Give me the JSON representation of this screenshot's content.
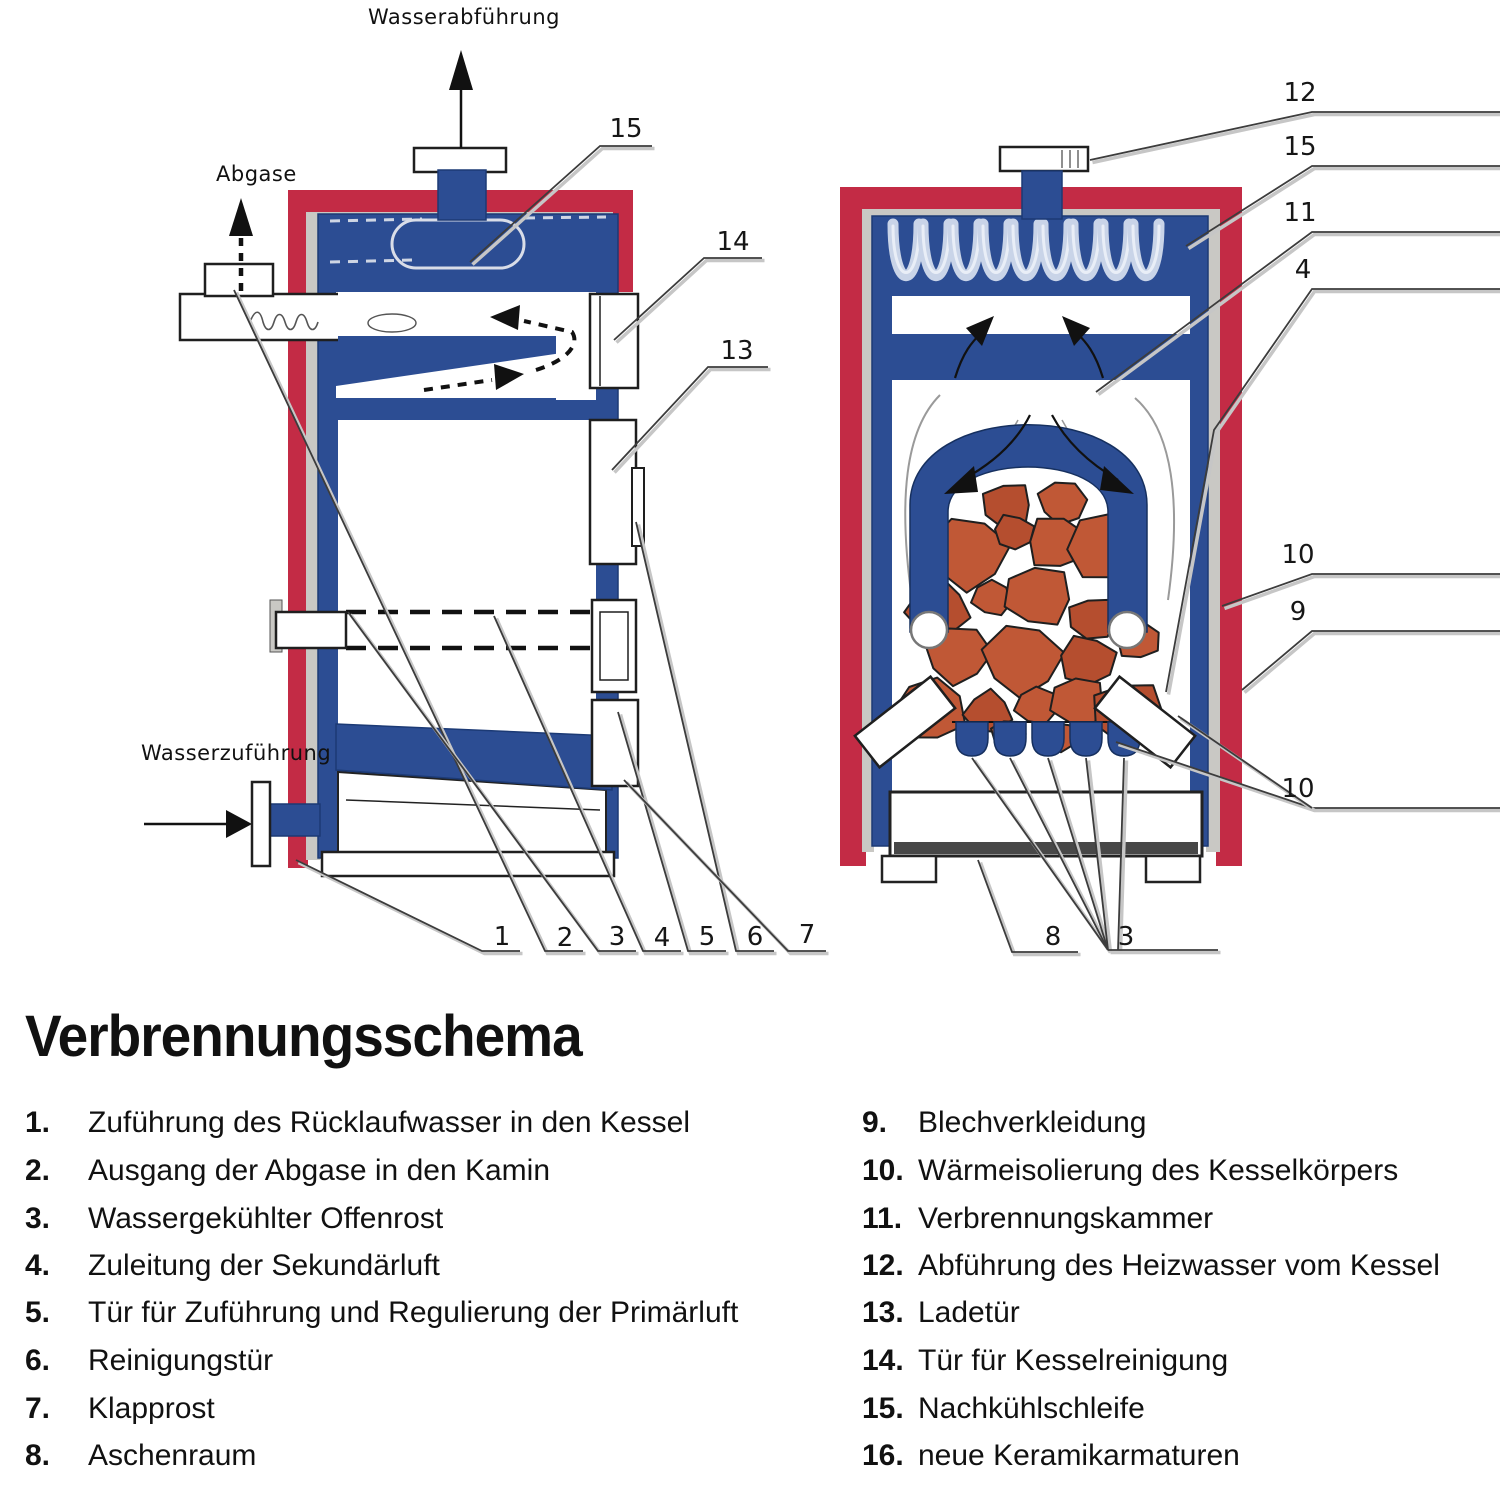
{
  "title": "Verbrennungsschema",
  "diagram": {
    "flow_labels": {
      "water_out": "Wasserabführung",
      "flue_gas": "Abgase",
      "water_in": "Wasserzuführung"
    },
    "left_callouts": {
      "c15": "15",
      "c14": "14",
      "c13": "13",
      "c1": "1",
      "c2": "2",
      "c3": "3",
      "c4": "4",
      "c5": "5",
      "c6": "6",
      "c7": "7"
    },
    "right_callouts": {
      "c12": "12",
      "c15": "15",
      "c11": "11",
      "c4": "4",
      "c10_top": "10",
      "c9": "9",
      "c10_bottom": "10",
      "c8": "8",
      "c3": "3"
    }
  },
  "colors": {
    "casing_red": "#c32b45",
    "water_blue": "#2c4d93",
    "insulation_gray": "#c9c8c4",
    "fuel_terracotta": "#c05836",
    "ash_dark": "#474747"
  },
  "legend": {
    "left": [
      {
        "num": "1.",
        "text": "Zuführung des Rücklaufwasser in den Kessel"
      },
      {
        "num": "2.",
        "text": "Ausgang der Abgase in den Kamin"
      },
      {
        "num": "3.",
        "text": "Wassergekühlter Offenrost"
      },
      {
        "num": "4.",
        "text": "Zuleitung der Sekundärluft"
      },
      {
        "num": "5.",
        "text": "Tür für Zuführung und Regulierung der Primärluft"
      },
      {
        "num": "6.",
        "text": "Reinigungstür"
      },
      {
        "num": "7.",
        "text": "Klapprost"
      },
      {
        "num": "8.",
        "text": "Aschenraum"
      }
    ],
    "right": [
      {
        "num": "9.",
        "text": "Blechverkleidung"
      },
      {
        "num": "10.",
        "text": "Wärmeisolierung des Kesselkörpers"
      },
      {
        "num": "11.",
        "text": "Verbrennungskammer"
      },
      {
        "num": "12.",
        "text": "Abführung des Heizwasser vom Kessel"
      },
      {
        "num": "13.",
        "text": "Ladetür"
      },
      {
        "num": "14.",
        "text": "Tür für Kesselreinigung"
      },
      {
        "num": "15.",
        "text": "Nachkühlschleife"
      },
      {
        "num": "16.",
        "text": "neue Keramikarmaturen"
      }
    ]
  }
}
